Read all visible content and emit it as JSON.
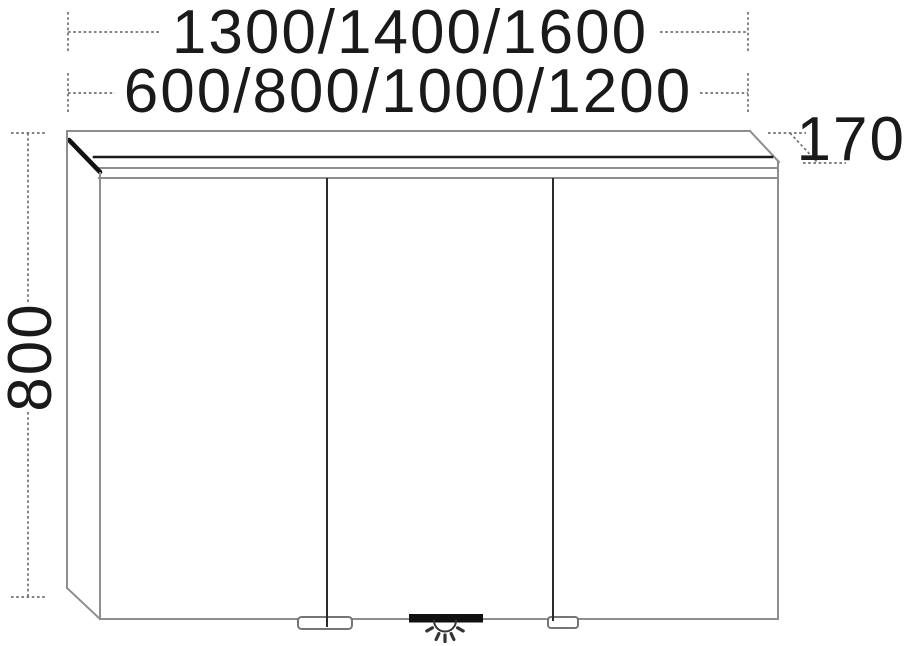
{
  "diagram": {
    "title": "Mirror cabinet technical drawing, front elevation",
    "dimensions": {
      "width_row1": "1300/1400/1600",
      "width_row2": "600/800/1000/1200",
      "height": "800",
      "depth": "170"
    },
    "cabinet": {
      "door_count": 3,
      "features": [
        "top-light-cornice",
        "two-door-handles",
        "bottom-light"
      ],
      "icons": [
        "light-rays-icon"
      ]
    },
    "colors": {
      "background": "#ffffff",
      "line_gray": "#8e8e8e",
      "line_black": "#1a1a1a",
      "dimension_line": "#707070"
    }
  }
}
